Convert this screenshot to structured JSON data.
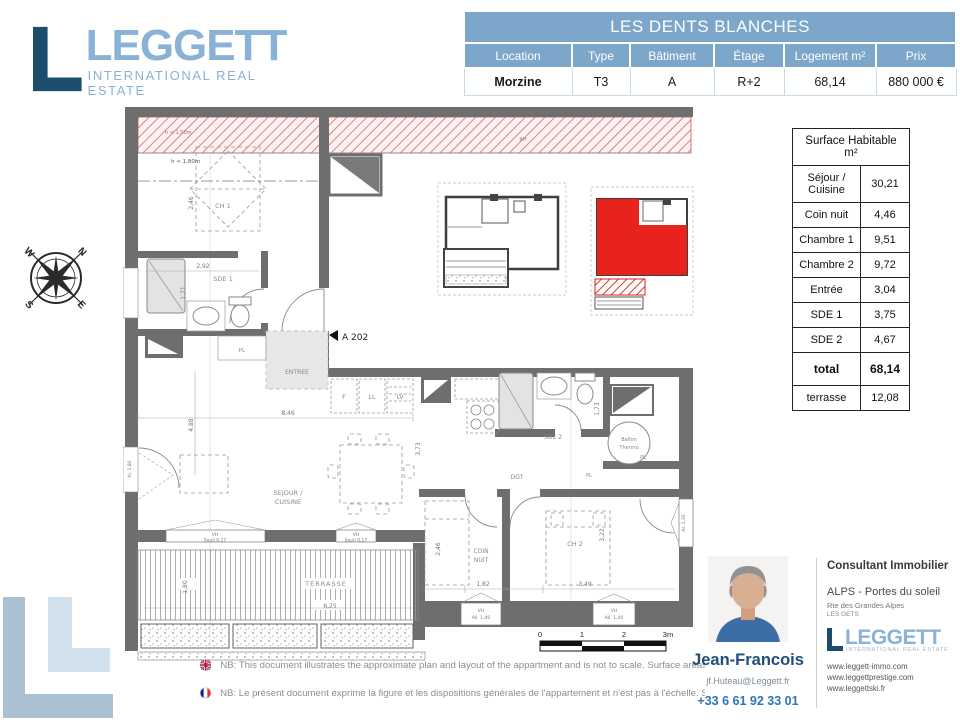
{
  "logo": {
    "name": "LEGGETT",
    "tagline": "INTERNATIONAL REAL ESTATE"
  },
  "property_table": {
    "title": "LES DENTS BLANCHES",
    "columns": [
      "Location",
      "Type",
      "Bâtiment",
      "Étage",
      "Logement m²",
      "Prix"
    ],
    "row": [
      "Morzine",
      "T3",
      "A",
      "R+2",
      "68,14",
      "880 000 €"
    ]
  },
  "surface_table": {
    "header": "Surface Habitable m²",
    "rows": [
      {
        "label": "Séjour / Cuisine",
        "value": "30,21"
      },
      {
        "label": "Coin nuit",
        "value": "4,46"
      },
      {
        "label": "Chambre 1",
        "value": "9,51"
      },
      {
        "label": "Chambre 2",
        "value": "9,72"
      },
      {
        "label": "Entrée",
        "value": "3,04"
      },
      {
        "label": "SDE 1",
        "value": "3,75"
      },
      {
        "label": "SDE 2",
        "value": "4,67"
      },
      {
        "label": "total",
        "value": "68,14"
      },
      {
        "label": "terrasse",
        "value": "12,08"
      }
    ]
  },
  "compass": {
    "n": "N",
    "e": "E",
    "s": "S",
    "w": "W"
  },
  "floor_plan": {
    "unit_label": "A 202",
    "rooms": {
      "ch1": "CH 1",
      "sde1": "SDE 1",
      "sde2": "SDE 2",
      "pl": "PL",
      "entree": "ENTREE",
      "sejour_line1": "SEJOUR /",
      "sejour_line2": "CUISINE",
      "coin_line1": "COIN",
      "coin_line2": "NUIT",
      "ch2": "CH 2",
      "dgt": "DGT",
      "terrasse": "TERRASSE",
      "ballon_line1": "Ballon",
      "ballon_line2": "Thermo",
      "fridge": "F",
      "washer": "LL",
      "dishwasher": "LV",
      "rh": "RH"
    },
    "annotations": {
      "low_ceiling_band": "h < 1,50m",
      "low_ceiling": "h < 1,80m"
    },
    "dims": {
      "ch1_h": "2,46",
      "sde1_w": "2,92",
      "sde1_h": "1,71",
      "sejour_h": "4,88",
      "sejour_w": "8,46",
      "sejour_d": "3,73",
      "terrasse_h": "1,80",
      "terrasse_w": "6,25",
      "coin_w": "1,82",
      "ch2_w": "3,49",
      "ch2_h": "3,22",
      "coin_h": "2,46",
      "sde2_h": "1,73"
    },
    "windows": {
      "vh": "VH",
      "seuil": "Seuil 0,17",
      "all100": "All. 1,00",
      "al130": "Al. 1,30",
      "al180": "Al. 1,80"
    },
    "scale_bar": {
      "t0": "0",
      "t1": "1",
      "t2": "2",
      "t3": "3m"
    }
  },
  "notes": {
    "en": "NB: This document illustrates the approximate plan and layout of the appartment and is not to scale. Surface areas as measured by surveyor.",
    "fr": "NB: Le présent document exprime la figure et les dispositions générales de l'appartement et n'est pas à l'échelle. Surfaces mesurées par diagno"
  },
  "consultant": {
    "name": "Jean-Francois",
    "email": "jf.Huteau@Leggett.fr",
    "phone": "+33 6 61 92 33 01",
    "title": "Consultant Immobilier",
    "region": "ALPS - Portes du soleil",
    "address1": "Rte des Grandes Alpes",
    "address2": "LES GETS",
    "websites": [
      "www.leggett-immo.com",
      "www.leggettprestige.com",
      "www.leggettski.fr"
    ],
    "logo": {
      "name": "LEGGETT",
      "tagline": "INTERNATIONAL REAL ESTATE"
    }
  },
  "colors": {
    "table_blue": "#7da6cb",
    "logo_navy": "#1d4d6d",
    "logo_blue": "#8ab1d6",
    "plan_red": "#e8231d",
    "wall_gray": "#6e6e6e",
    "name_navy": "#1f4e79",
    "phone_blue": "#2e74b5"
  }
}
